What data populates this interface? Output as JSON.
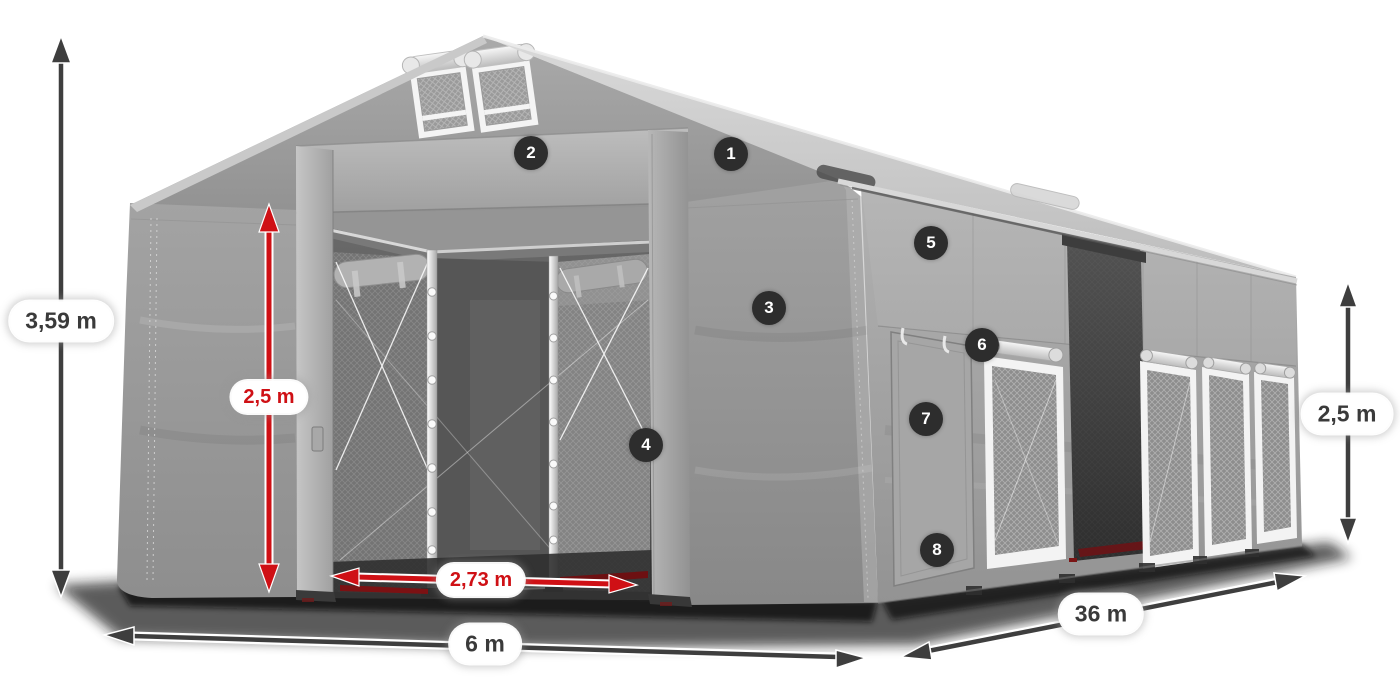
{
  "page": {
    "background": "#ffffff",
    "subject": "storage tent dimension diagram"
  },
  "dimension_labels": [
    {
      "name": "total-height",
      "text": "3,59 m",
      "style": "dark"
    },
    {
      "name": "door-height",
      "text": "2,5 m",
      "style": "red"
    },
    {
      "name": "door-width",
      "text": "2,73 m",
      "style": "red"
    },
    {
      "name": "front-width",
      "text": "6 m",
      "style": "dark"
    },
    {
      "name": "length",
      "text": "36 m",
      "style": "dark"
    },
    {
      "name": "side-height",
      "text": "2,5 m",
      "style": "dark"
    }
  ],
  "feature_markers": [
    {
      "number": "1"
    },
    {
      "number": "2"
    },
    {
      "number": "3"
    },
    {
      "number": "4"
    },
    {
      "number": "5"
    },
    {
      "number": "6"
    },
    {
      "number": "7"
    },
    {
      "number": "8"
    }
  ],
  "icons": {
    "dimension_arrow": "double-headed-arrow",
    "feature_marker": "numbered-dark-circle"
  },
  "colors": {
    "accent_red": "#cf1015",
    "arrow_dark": "#3e3e3e",
    "marker_background": "#2d2d2d",
    "marker_text": "#ffffff",
    "label_text_dark": "#3a3a3a",
    "label_background": "#ffffff",
    "tent_light_gray": "#d6d6d6",
    "tent_mid_gray": "#a0a0a0",
    "tent_dark_interior": "#4a4a4a"
  }
}
